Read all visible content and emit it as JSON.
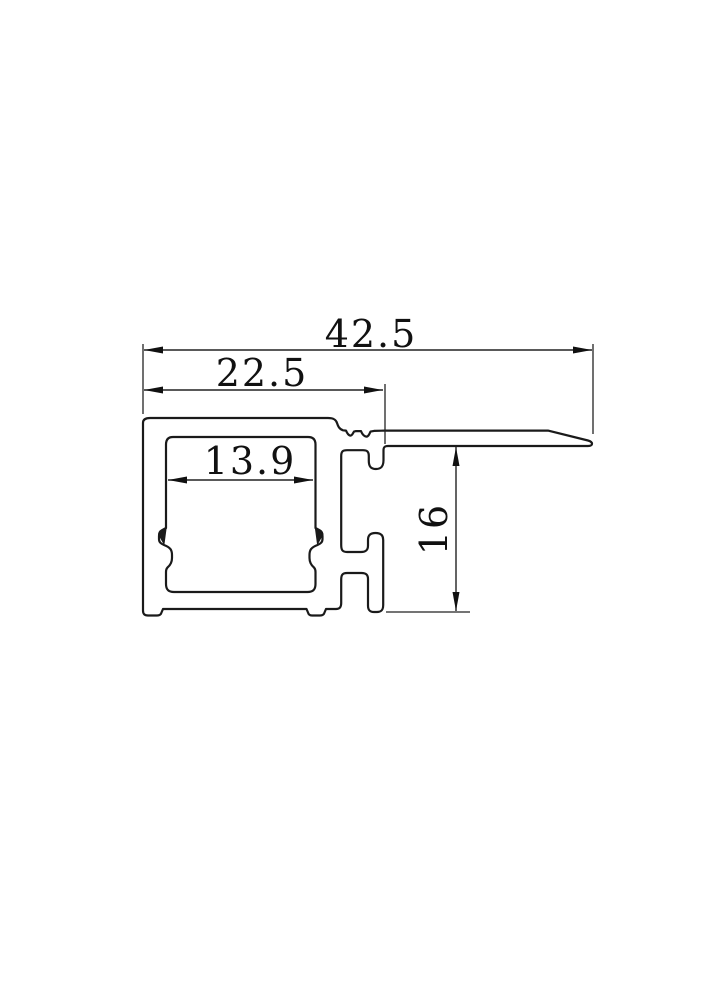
{
  "drawing": {
    "background": "#ffffff",
    "line_color": "#1a1a1a",
    "dimension_color": "#222222",
    "dimensions": {
      "total_width": "42.5",
      "channel_width": "22.5",
      "inner_width": "13.9",
      "height": "16"
    }
  }
}
